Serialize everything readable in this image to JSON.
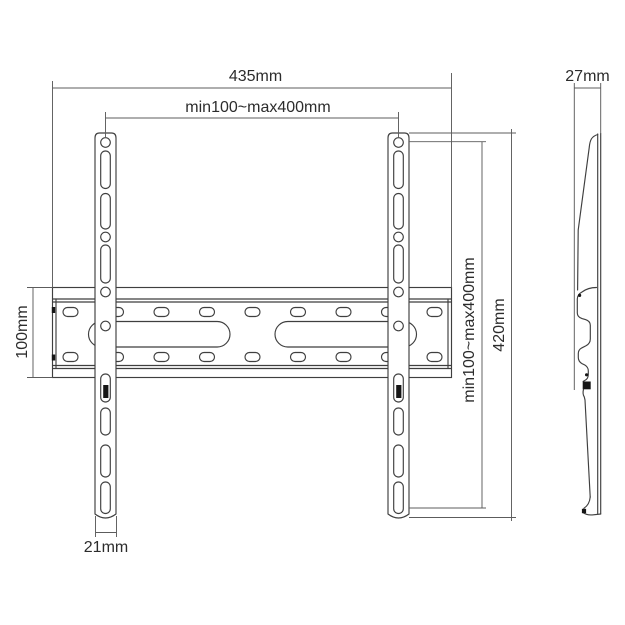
{
  "drawing": {
    "subject": "tv-wall-mount-technical-drawing",
    "views": {
      "front": "front-view",
      "side": "side-profile-view"
    }
  },
  "labels": {
    "overall_width": "435mm",
    "hole_pattern_width": "min100~max400mm",
    "rail_height": "100mm",
    "arm_width": "21mm",
    "hole_pattern_height": "min100~max400mm",
    "arm_height": "420mm",
    "depth": "27mm"
  },
  "colors": {
    "background": "#ffffff",
    "object_line": "#3f3f3f",
    "dimension_line": "#5c5c5c",
    "text": "#2c2c2c",
    "lock_mark": "#161616"
  }
}
